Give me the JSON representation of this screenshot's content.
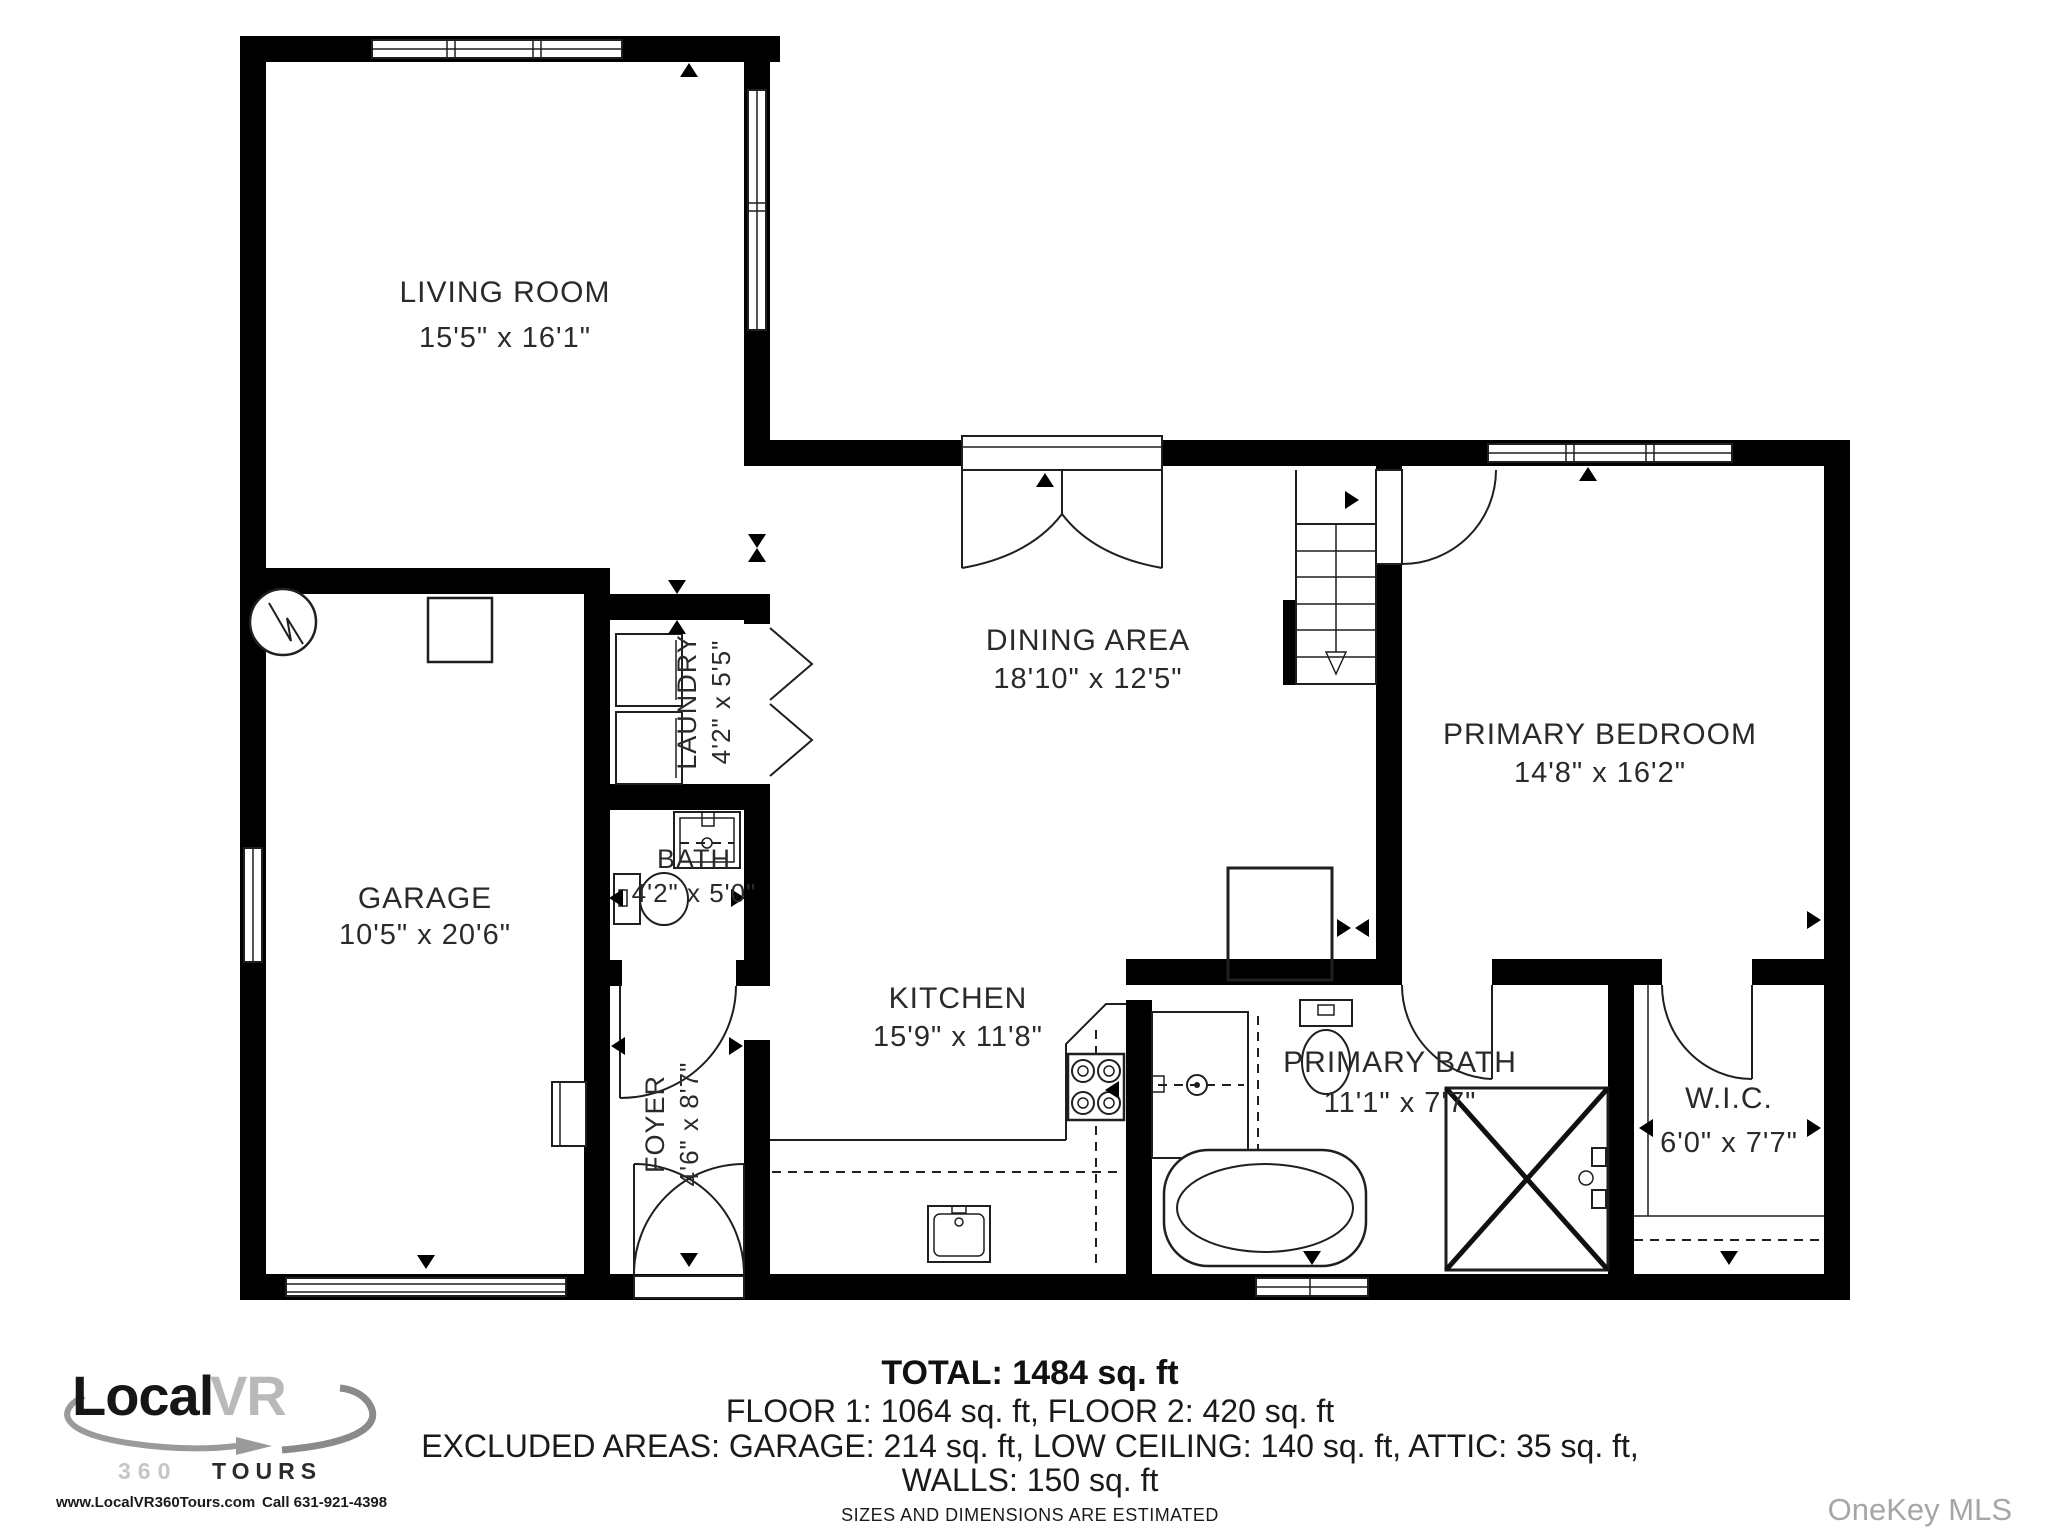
{
  "rooms": {
    "living_room": {
      "name": "LIVING ROOM",
      "dims": "15'5\" x 16'1\""
    },
    "dining": {
      "name": "DINING AREA",
      "dims": "18'10\" x 12'5\""
    },
    "kitchen": {
      "name": "KITCHEN",
      "dims": "15'9\" x 11'8\""
    },
    "garage": {
      "name": "GARAGE",
      "dims": "10'5\" x 20'6\""
    },
    "laundry": {
      "name": "LAUNDRY",
      "dims": "4'2\" x 5'5\""
    },
    "bath": {
      "name": "BATH",
      "dims": "4'2\" x 5'0\""
    },
    "foyer": {
      "name": "FOYER",
      "dims": "4'6\" x 8'7\""
    },
    "primary_bedroom": {
      "name": "PRIMARY BEDROOM",
      "dims": "14'8\" x 16'2\""
    },
    "primary_bath": {
      "name": "PRIMARY BATH",
      "dims": "11'1\" x 7'7\""
    },
    "wic": {
      "name": "W.I.C.",
      "dims": "6'0\" x 7'7\""
    }
  },
  "summary": {
    "total": "TOTAL: 1484 sq. ft",
    "floors": "FLOOR 1: 1064 sq. ft, FLOOR 2: 420 sq. ft",
    "excluded": "EXCLUDED AREAS: GARAGE: 214 sq. ft, LOW CEILING: 140 sq. ft, ATTIC: 35 sq. ft,",
    "walls": "WALLS: 150 sq. ft",
    "disclaimer": "SIZES AND DIMENSIONS ARE ESTIMATED"
  },
  "logo": {
    "brand_local": "Local",
    "brand_vr": "VR",
    "tours_360": "360",
    "tours_word": "TOURS",
    "website": "www.LocalVR360Tours.com",
    "phone": "Call 631-921-4398"
  },
  "watermark": "OneKey MLS",
  "colors": {
    "wall": "#000000",
    "line": "#1f1f1f",
    "text": "#2a2a2a",
    "logo_gray": "#b9b9b9",
    "watermark_gray": "#a6a6a6"
  }
}
